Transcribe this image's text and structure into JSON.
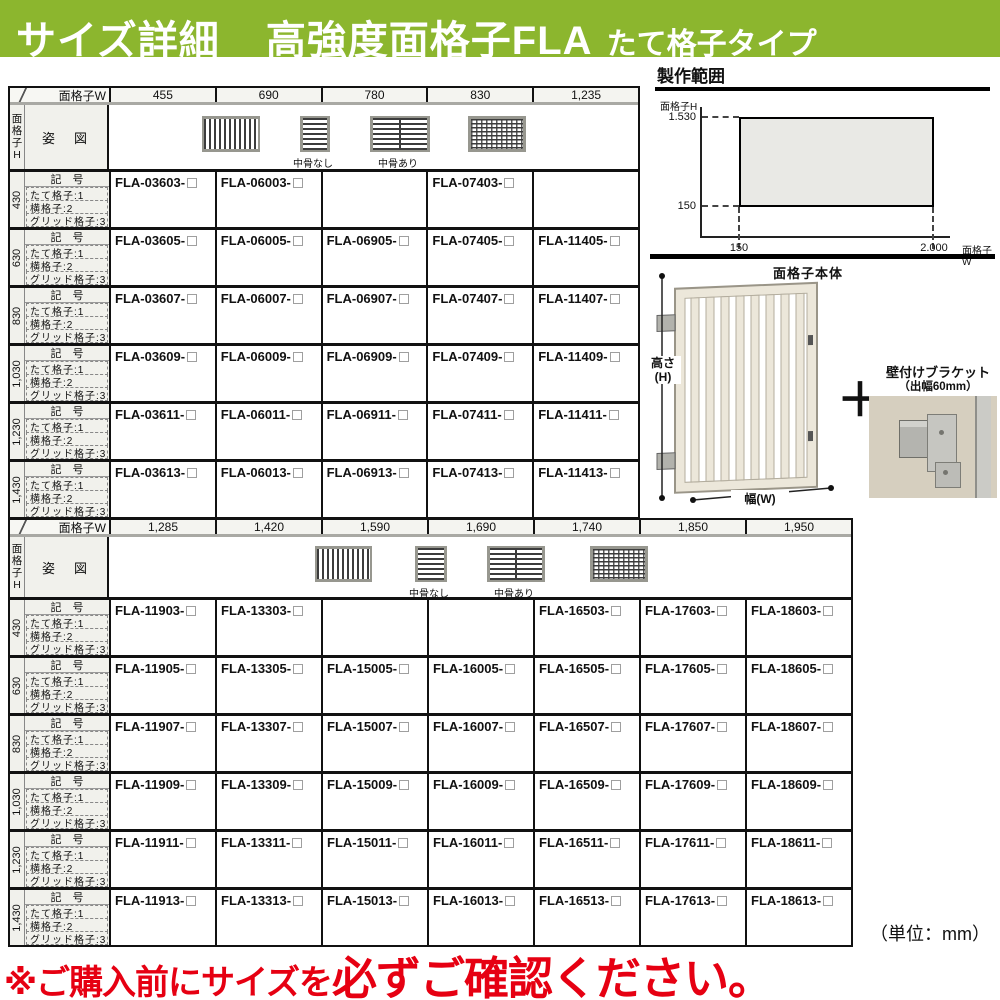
{
  "page": {
    "title_left": "サイズ詳細",
    "title_main": "高強度面格子FLA",
    "title_sub": "たて格子タイプ",
    "unit_note": "（単位：mm）",
    "warning_prefix": "※ご購入前にサイズを",
    "warning_emphasis": "必ずご確認ください。"
  },
  "colors": {
    "header_green": "#8cb62e",
    "warning_red": "#e60012",
    "label_cell_gray": "#f1f1ec",
    "range_fill_gray": "#e9e9e5"
  },
  "table_common": {
    "w_header": "面格子W",
    "h_header": "面格子H",
    "pose_label": "姿　図",
    "row_header": "記　号",
    "type_labels": [
      "たて格子:1",
      "横格子:2",
      "グリッド格子:3"
    ],
    "icon_labels": {
      "no_midrail": "中骨なし",
      "with_midrail": "中骨あり"
    },
    "icons": [
      "vertical-lattice",
      "horizontal-lattice-no-midrail",
      "horizontal-lattice-with-midrail",
      "grid-lattice"
    ]
  },
  "upper_table": {
    "widths": [
      "455",
      "690",
      "780",
      "830",
      "1,235"
    ],
    "rows": [
      {
        "h": "430",
        "codes": [
          "FLA-03603-",
          "FLA-06003-",
          "",
          "FLA-07403-",
          ""
        ]
      },
      {
        "h": "630",
        "codes": [
          "FLA-03605-",
          "FLA-06005-",
          "FLA-06905-",
          "FLA-07405-",
          "FLA-11405-"
        ]
      },
      {
        "h": "830",
        "codes": [
          "FLA-03607-",
          "FLA-06007-",
          "FLA-06907-",
          "FLA-07407-",
          "FLA-11407-"
        ]
      },
      {
        "h": "1,030",
        "codes": [
          "FLA-03609-",
          "FLA-06009-",
          "FLA-06909-",
          "FLA-07409-",
          "FLA-11409-"
        ]
      },
      {
        "h": "1,230",
        "codes": [
          "FLA-03611-",
          "FLA-06011-",
          "FLA-06911-",
          "FLA-07411-",
          "FLA-11411-"
        ]
      },
      {
        "h": "1,430",
        "codes": [
          "FLA-03613-",
          "FLA-06013-",
          "FLA-06913-",
          "FLA-07413-",
          "FLA-11413-"
        ]
      }
    ]
  },
  "lower_table": {
    "widths": [
      "1,285",
      "1,420",
      "1,590",
      "1,690",
      "1,740",
      "1,850",
      "1,950"
    ],
    "rows": [
      {
        "h": "430",
        "codes": [
          "FLA-11903-",
          "FLA-13303-",
          "",
          "",
          "FLA-16503-",
          "FLA-17603-",
          "FLA-18603-"
        ]
      },
      {
        "h": "630",
        "codes": [
          "FLA-11905-",
          "FLA-13305-",
          "FLA-15005-",
          "FLA-16005-",
          "FLA-16505-",
          "FLA-17605-",
          "FLA-18605-"
        ]
      },
      {
        "h": "830",
        "codes": [
          "FLA-11907-",
          "FLA-13307-",
          "FLA-15007-",
          "FLA-16007-",
          "FLA-16507-",
          "FLA-17607-",
          "FLA-18607-"
        ]
      },
      {
        "h": "1,030",
        "codes": [
          "FLA-11909-",
          "FLA-13309-",
          "FLA-15009-",
          "FLA-16009-",
          "FLA-16509-",
          "FLA-17609-",
          "FLA-18609-"
        ]
      },
      {
        "h": "1,230",
        "codes": [
          "FLA-11911-",
          "FLA-13311-",
          "FLA-15011-",
          "FLA-16011-",
          "FLA-16511-",
          "FLA-17611-",
          "FLA-18611-"
        ]
      },
      {
        "h": "1,430",
        "codes": [
          "FLA-11913-",
          "FLA-13313-",
          "FLA-15013-",
          "FLA-16013-",
          "FLA-16513-",
          "FLA-17613-",
          "FLA-18613-"
        ]
      }
    ]
  },
  "range_chart": {
    "title": "製作範囲",
    "y_axis_label": "面格子H",
    "x_axis_label": "面格子W",
    "y_max": "1.530",
    "y_min": "150",
    "x_min": "150",
    "x_max": "2.000"
  },
  "product": {
    "body_label": "面格子本体",
    "height_label_1": "高さ",
    "height_label_2": "(H)",
    "width_label": "幅(W)",
    "plus": "＋",
    "bracket_title": "壁付けブラケット",
    "bracket_sub": "（出幅60mm）"
  }
}
